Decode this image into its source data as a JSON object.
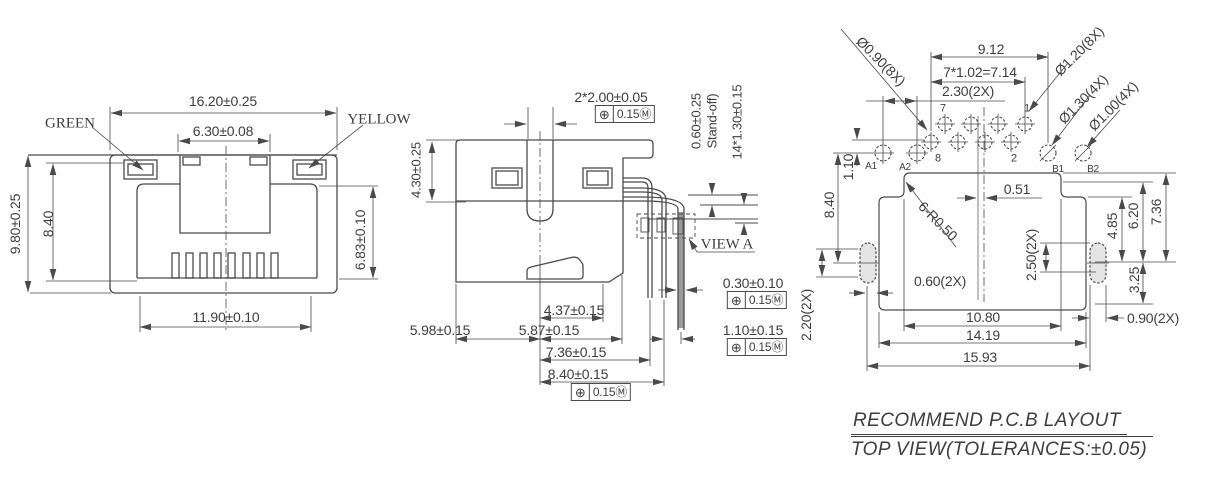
{
  "front_view": {
    "led_left": "GREEN",
    "led_right": "YELLOW",
    "dim_overall_width": "16.20±0.25",
    "dim_opening_width": "6.30±0.08",
    "dim_overall_height": "9.80±0.25",
    "dim_window_height": "8.40",
    "dim_body_height": "6.83±0.10",
    "dim_bottom_width": "11.90±0.10"
  },
  "side_view": {
    "dim_post_pitch": "2*2.00±0.05",
    "dim_shield_height": "4.30±0.25",
    "dim_standoff": "0.60±0.25",
    "standoff_label": "Stand-off)",
    "dim_pin_tail": "14*1.30±0.15",
    "view_a_label": "VIEW A",
    "dim_pin_width": "0.30±0.10",
    "dim_437": "4.37±0.15",
    "dim_598": "5.98±0.15",
    "dim_587": "5.87±0.15",
    "dim_110": "1.10±0.15",
    "dim_736": "7.36±0.15",
    "dim_840": "8.40±0.15"
  },
  "tolerance_frame": {
    "symbol": "⊕",
    "value": "0.15Ⓜ"
  },
  "pcb_view": {
    "hole_note_090": "Ø0.90(8X)",
    "hole_note_120": "Ø1.20(8X)",
    "hole_note_130": "Ø1.30(4X)",
    "hole_note_100": "Ø1.00(4X)",
    "dim_912": "9.12",
    "dim_pitch": "7*1.02=7.14",
    "dim_230": "2.30(2X)",
    "pin_7": "7",
    "pin_1": "1",
    "pin_8": "8",
    "pin_2": "2",
    "hole_a1": "A1",
    "hole_a2": "A2",
    "hole_b1": "B1",
    "hole_b2": "B2",
    "dim_110": "1.10",
    "dim_840": "8.40",
    "dim_220": "2.20(2X)",
    "dim_051": "0.51",
    "radius_note": "6-R0.50",
    "dim_060": "0.60(2X)",
    "dim_250": "2.50(2X)",
    "dim_485": "4.85",
    "dim_620": "6.20",
    "dim_736": "7.36",
    "dim_325": "3.25",
    "dim_090": "0.90(2X)",
    "dim_1080": "10.80",
    "dim_1419": "14.19",
    "dim_1593": "15.93"
  },
  "footer": {
    "line1": "RECOMMEND P.C.B LAYOUT",
    "line2": "TOP VIEW(TOLERANCES:±0.05)"
  }
}
